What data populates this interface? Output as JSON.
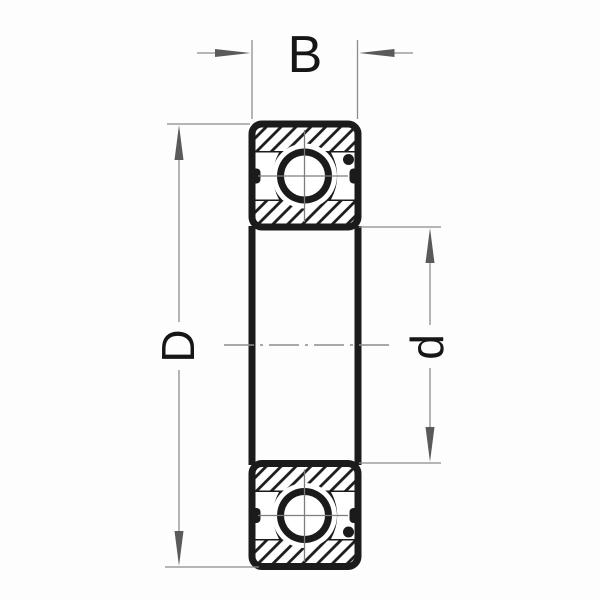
{
  "drawing": {
    "kind": "deep-groove-ball-bearing-cross-section",
    "labels": {
      "width": "B",
      "outer_diameter": "D",
      "bore_diameter": "d"
    },
    "colors": {
      "line_black": "#1b1b1b",
      "dimension_gray": "#8c8c8c",
      "arrow_gray": "#5a5a5a",
      "background": "#fdfdfd"
    }
  }
}
